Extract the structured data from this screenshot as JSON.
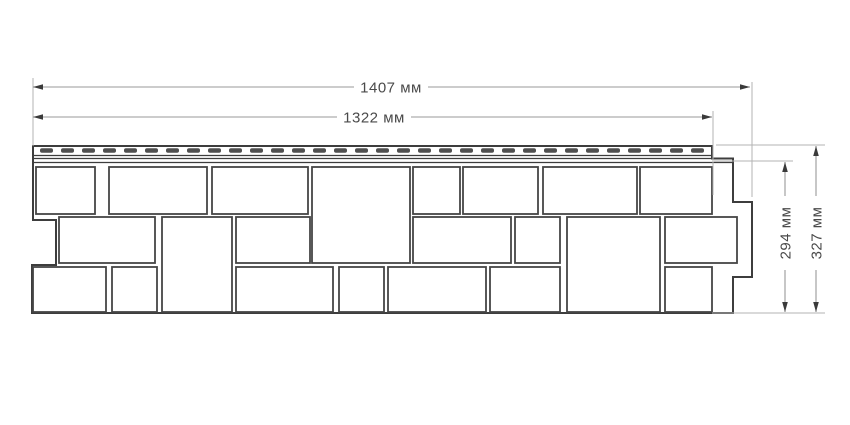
{
  "drawing": {
    "colors": {
      "background": "#ffffff",
      "panel_line": "#3d3d3d",
      "stone_line": "#454545",
      "slot_fill": "#4f4f4f",
      "dim_line": "#999999",
      "extension_line": "#b3b3b3",
      "arrow": "#3a3a3a",
      "label_text": "#4a4a4a"
    },
    "labels": {
      "width_total": "1407 мм",
      "width_hem": "1322 мм",
      "height_face": "294 мм",
      "height_total": "327 мм"
    },
    "panel": {
      "outline": "M33,146 L712,146 L712,158.5 L733,158.5 L733,202 L752,202 L752,277 L733,277 L733,313 L32,313 L32,265 L56,265 L56,220 L33,220 Z",
      "hem_lines": [
        [
          33,
          155.5,
          712,
          155.5
        ],
        [
          33,
          158.5,
          712,
          158.5
        ],
        [
          33,
          162.5,
          733,
          162.5
        ]
      ],
      "slots": {
        "x0": 40,
        "pitch": 21,
        "count": 32,
        "w": 13,
        "h": 4.5,
        "y": 148.2,
        "rx": 2
      },
      "stones": [
        [
          36,
          167,
          59,
          47
        ],
        [
          109,
          167,
          98,
          47
        ],
        [
          212,
          167,
          96,
          47
        ],
        [
          413,
          167,
          47,
          47
        ],
        [
          463,
          167,
          75,
          47
        ],
        [
          543,
          167,
          94,
          47
        ],
        [
          640,
          167,
          72,
          47
        ],
        [
          312,
          167,
          98,
          96
        ],
        [
          59,
          217,
          96,
          46
        ],
        [
          236,
          217,
          74,
          46
        ],
        [
          413,
          217,
          98,
          46
        ],
        [
          515,
          217,
          45,
          46
        ],
        [
          665,
          217,
          72,
          46
        ],
        [
          162,
          217,
          70,
          95
        ],
        [
          567,
          217,
          93,
          95
        ],
        [
          33,
          267,
          73,
          45
        ],
        [
          112,
          267,
          45,
          45
        ],
        [
          236,
          267,
          97,
          45
        ],
        [
          339,
          267,
          45,
          45
        ],
        [
          388,
          267,
          98,
          45
        ],
        [
          490,
          267,
          70,
          45
        ],
        [
          665,
          267,
          47,
          45
        ]
      ]
    },
    "dims": {
      "horizontal": [
        {
          "name": "total-width",
          "y": 87,
          "x1": 33,
          "x2": 750,
          "text_x": 391
        },
        {
          "name": "hem-width",
          "y": 117,
          "x1": 33,
          "x2": 712,
          "text_x": 374
        }
      ],
      "vertical": [
        {
          "name": "face-height",
          "x": 785,
          "y1": 162,
          "y2": 312,
          "text_y": 233
        },
        {
          "name": "total-height",
          "x": 816,
          "y1": 146,
          "y2": 312,
          "text_y": 233
        }
      ],
      "extensions": [
        [
          33,
          78,
          33,
          146
        ],
        [
          752,
          82,
          752,
          197
        ],
        [
          713,
          111,
          713,
          195
        ],
        [
          714,
          161,
          793,
          161
        ],
        [
          716,
          145,
          825,
          145
        ],
        [
          712,
          313,
          825,
          313
        ]
      ]
    }
  }
}
